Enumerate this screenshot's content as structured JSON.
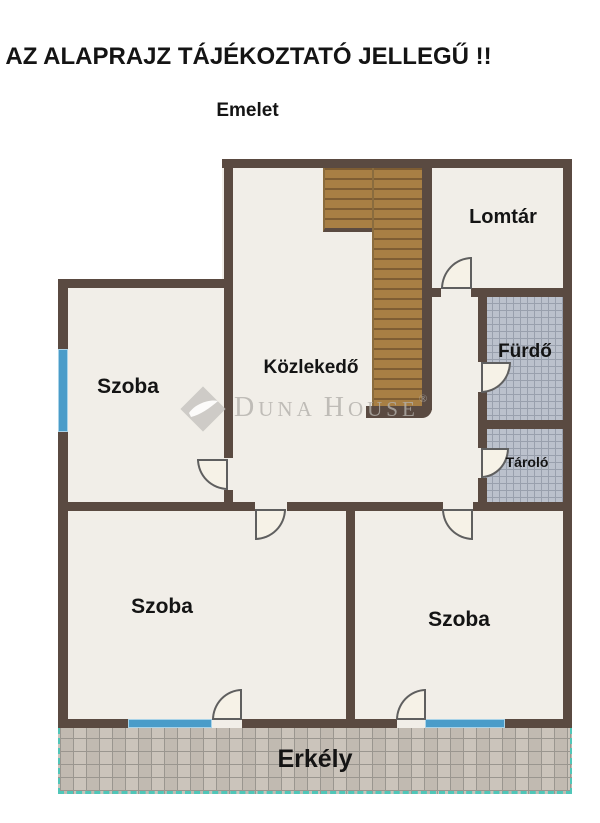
{
  "title": "AZ ALAPRAJZ TÁJÉKOZTATÓ JELLEGŰ !!",
  "subtitle": "Emelet",
  "rooms": {
    "lomtar": "Lomtár",
    "kozlekedo": "Közlekedő",
    "szoba_left": "Szoba",
    "furdo": "Fürdő",
    "tarolo": "Tároló",
    "szoba_bottom_left": "Szoba",
    "szoba_bottom_right": "Szoba",
    "erkely": "Erkély"
  },
  "watermark": {
    "brand_d": "D",
    "brand_una": "UNA",
    "brand_h": "H",
    "brand_ouse": "OUSE",
    "registered": "®"
  },
  "colors": {
    "wall": "#5a4a41",
    "floor": "#f1eee8",
    "stairs": "#a87f44",
    "bath_tile": "#bbc1cc",
    "balcony_tile": "#cbc4bb",
    "window_blue": "#4a9cc9",
    "balcony_teal": "#50c6b8",
    "watermark": "#b3b0ab",
    "text": "#141414"
  }
}
